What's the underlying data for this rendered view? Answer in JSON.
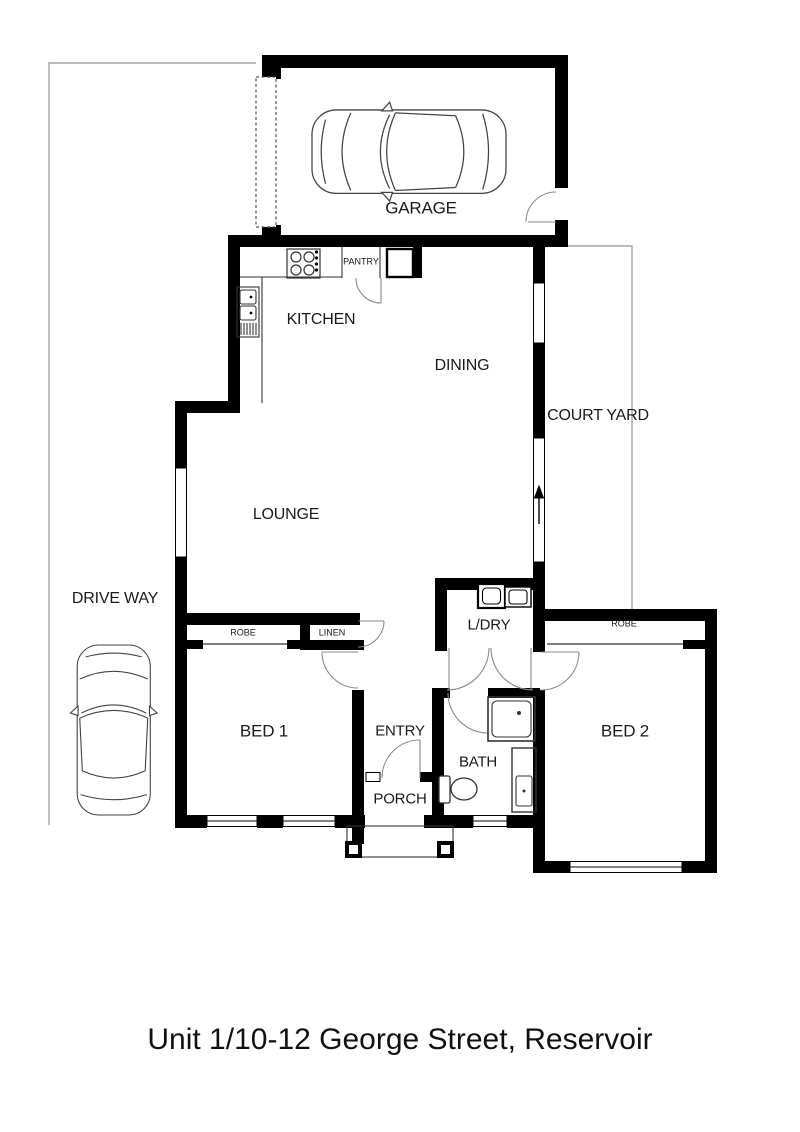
{
  "title": "Unit 1/10-12 George Street, Reservoir",
  "rooms": {
    "garage": {
      "label": "GARAGE"
    },
    "kitchen": {
      "label": "KITCHEN"
    },
    "pantry": {
      "label": "PANTRY"
    },
    "dining": {
      "label": "DINING"
    },
    "courtyard": {
      "label": "COURT YARD"
    },
    "lounge": {
      "label": "LOUNGE"
    },
    "driveway": {
      "label": "DRIVE WAY"
    },
    "robe1": {
      "label": "ROBE"
    },
    "linen": {
      "label": "LINEN"
    },
    "robe2": {
      "label": "ROBE"
    },
    "laundry": {
      "label": "L/DRY"
    },
    "bed1": {
      "label": "BED 1"
    },
    "bed2": {
      "label": "BED 2"
    },
    "entry": {
      "label": "ENTRY"
    },
    "bath": {
      "label": "BATH"
    },
    "porch": {
      "label": "PORCH"
    }
  },
  "icons": [
    "car-top-view-icon",
    "stove-icon",
    "sink-icon",
    "shower-icon",
    "toilet-icon",
    "vanity-icon",
    "laundry-trough-icon",
    "washing-machine-icon",
    "door-swing-icon",
    "sliding-door-arrow-icon"
  ],
  "colors": {
    "wall": "#000000",
    "fixture_line": "#444444",
    "door_arc": "#888888",
    "boundary_line": "#a6a6a6",
    "background": "#ffffff",
    "text": "#1a1a1a"
  }
}
